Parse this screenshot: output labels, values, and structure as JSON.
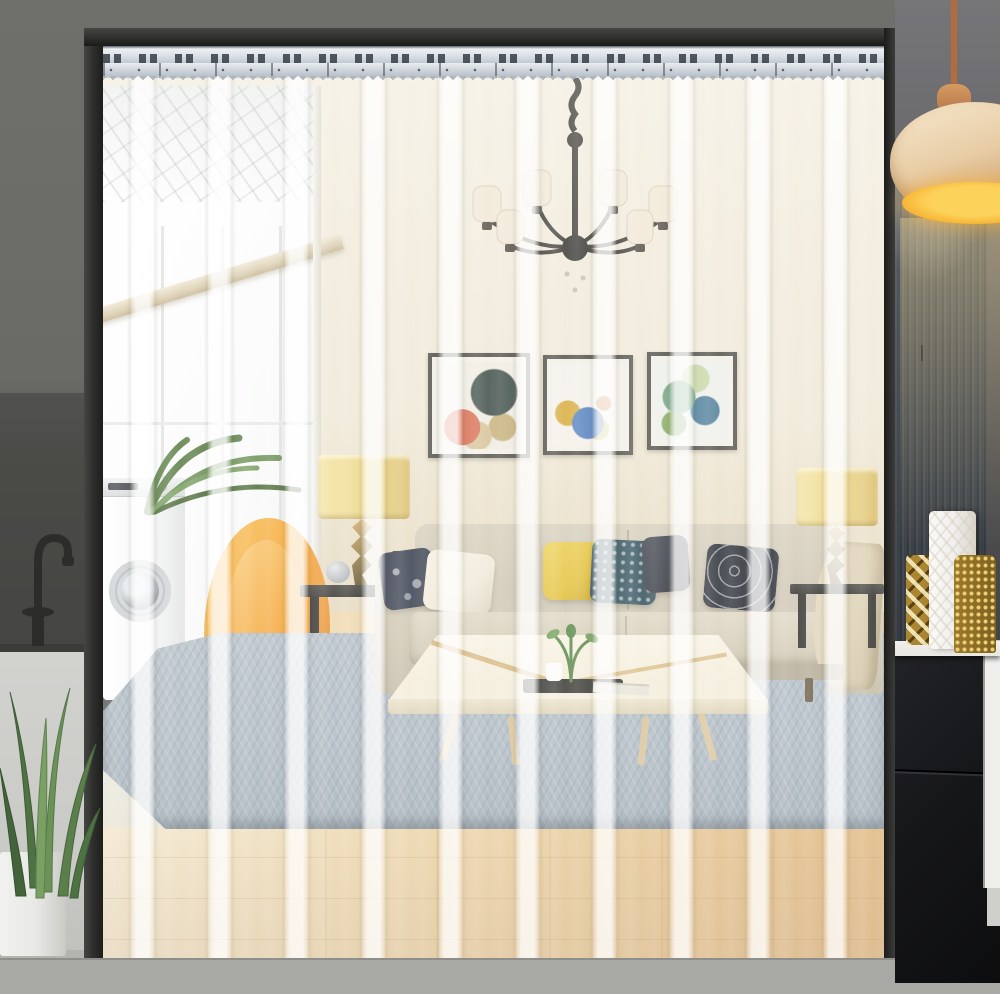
{
  "meta": {
    "domain": "Natural-Image",
    "description": "Product photograph of a transparent PVC strip door curtain mounted on a silver hanging rail across a doorway, seen in front of a bright modern living room",
    "visible_text": []
  },
  "palette": {
    "wall_outer": "#6f6f6b",
    "wall_outer_dark": "#4a4a47",
    "panel_counter": "#c9c9c6",
    "frame": "#2f2f2d",
    "rail_hi": "#f4f7f9",
    "rail_mid": "#b7bfc8",
    "rail_slot": "#363d46",
    "wall_cream": "#f0e8d7",
    "wall_warm": "#e6dabf",
    "window_white": "#fbfcfb",
    "beam": "#dccfb2",
    "wood": "#ecd2a1",
    "wood_pale": "#f4e9cf",
    "wood_deep": "#dfb478",
    "rug": "#aeb9c2",
    "threshold": "#525554",
    "sofa": "#cfc7b4",
    "pillow_navy": "#3a4150",
    "pillow_cream": "#f0ead9",
    "pillow_yellow": "#e4c23e",
    "pillow_teal": "#35545e",
    "throw": "#dbcfb2",
    "chair": "#f5a93c",
    "chair_deep": "#e5872a",
    "table_top": "#f4edda",
    "tray": "#3a3a36",
    "lamp_shade": "#eed98c",
    "lamp_base": "#97824f",
    "art_frame": "#585750",
    "washer": "#f5f6f5",
    "plant": "#587c46",
    "pot": "#e8e8e6",
    "pendant_shade": "#e8cda6",
    "pendant_glow": "#f7b637",
    "cord": "#b26d3e",
    "cab_wood": "#4a5158",
    "cab_black": "#161719",
    "gold": "#aa8532",
    "counter": "#eae8e3",
    "out_floor": "#a8a8a5",
    "shelf_white": "#f0efec"
  },
  "scene": {
    "objects": [
      "metal-mounting-rail",
      "pvc-strip-curtain",
      "door-frame",
      "chandelier",
      "abstract-art-triptych",
      "glass-patio-door",
      "washing-machine",
      "fern-plant",
      "orange-wingback-chair",
      "table-lamp-left",
      "table-lamp-right",
      "beige-sofa",
      "throw-pillows",
      "coffee-table",
      "blue-area-rug",
      "wood-floor",
      "kitchen-faucet",
      "snake-plant",
      "pendant-lamp",
      "dark-sideboard",
      "gold-vases",
      "white-vase"
    ],
    "strip_count": 10,
    "strip_overlap_highlights": true
  }
}
